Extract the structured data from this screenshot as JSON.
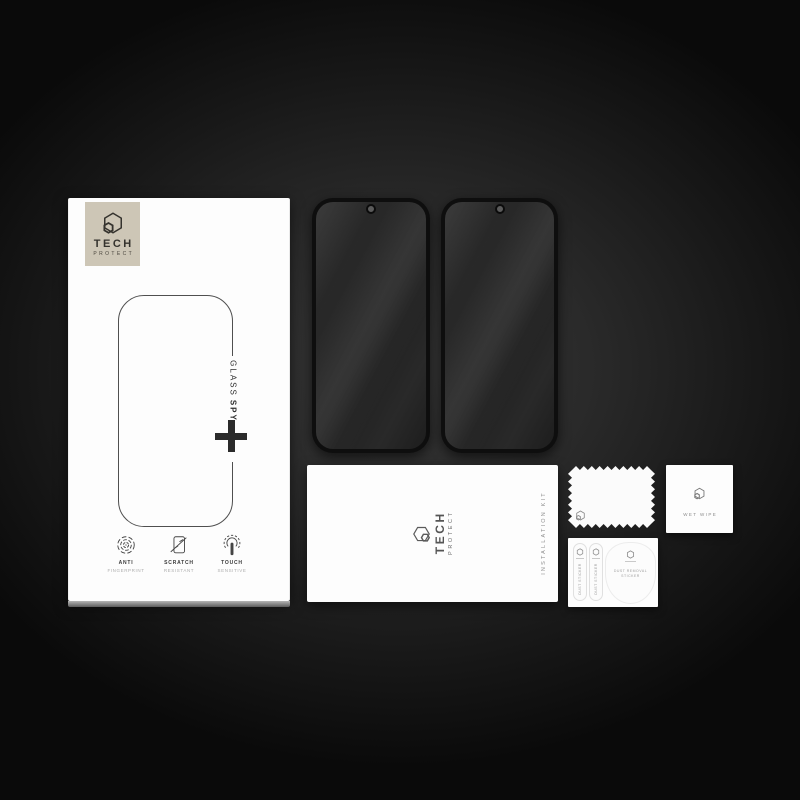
{
  "brand": {
    "line1": "TECH",
    "line2": "PROTECT"
  },
  "box": {
    "glass_label": "GLASS",
    "spy_label": "SPY",
    "features": [
      {
        "icon": "fingerprint-icon",
        "line1": "ANTI",
        "line2": "FINGERPRINT"
      },
      {
        "icon": "scratch-icon",
        "line1": "SCRATCH",
        "line2": "RESISTANT"
      },
      {
        "icon": "touch-icon",
        "line1": "TOUCH",
        "line2": "SENSITIVE"
      }
    ]
  },
  "kit_card": {
    "side_label": "INSTALLATION KIT"
  },
  "wet_wipe": {
    "label": "WET WIPE"
  },
  "sticker_sheet": {
    "strips": [
      {
        "label": "DUST STICKER"
      },
      {
        "label": "DUST STICKER"
      }
    ],
    "blob_line1": "DUST REMOVAL",
    "blob_line2": "STICKER"
  },
  "icons": {
    "brand": "hexagon-logo-icon",
    "plus": "plus-icon",
    "camera": "camera-hole",
    "features": [
      "fingerprint-icon",
      "scratch-icon",
      "touch-icon"
    ]
  },
  "colors": {
    "background": "#0a0a0a",
    "beige_plate": "#cdc6b6",
    "card_white": "#fdfdfd",
    "glass_dark": "#262626",
    "ink": "#2e2e2e"
  }
}
